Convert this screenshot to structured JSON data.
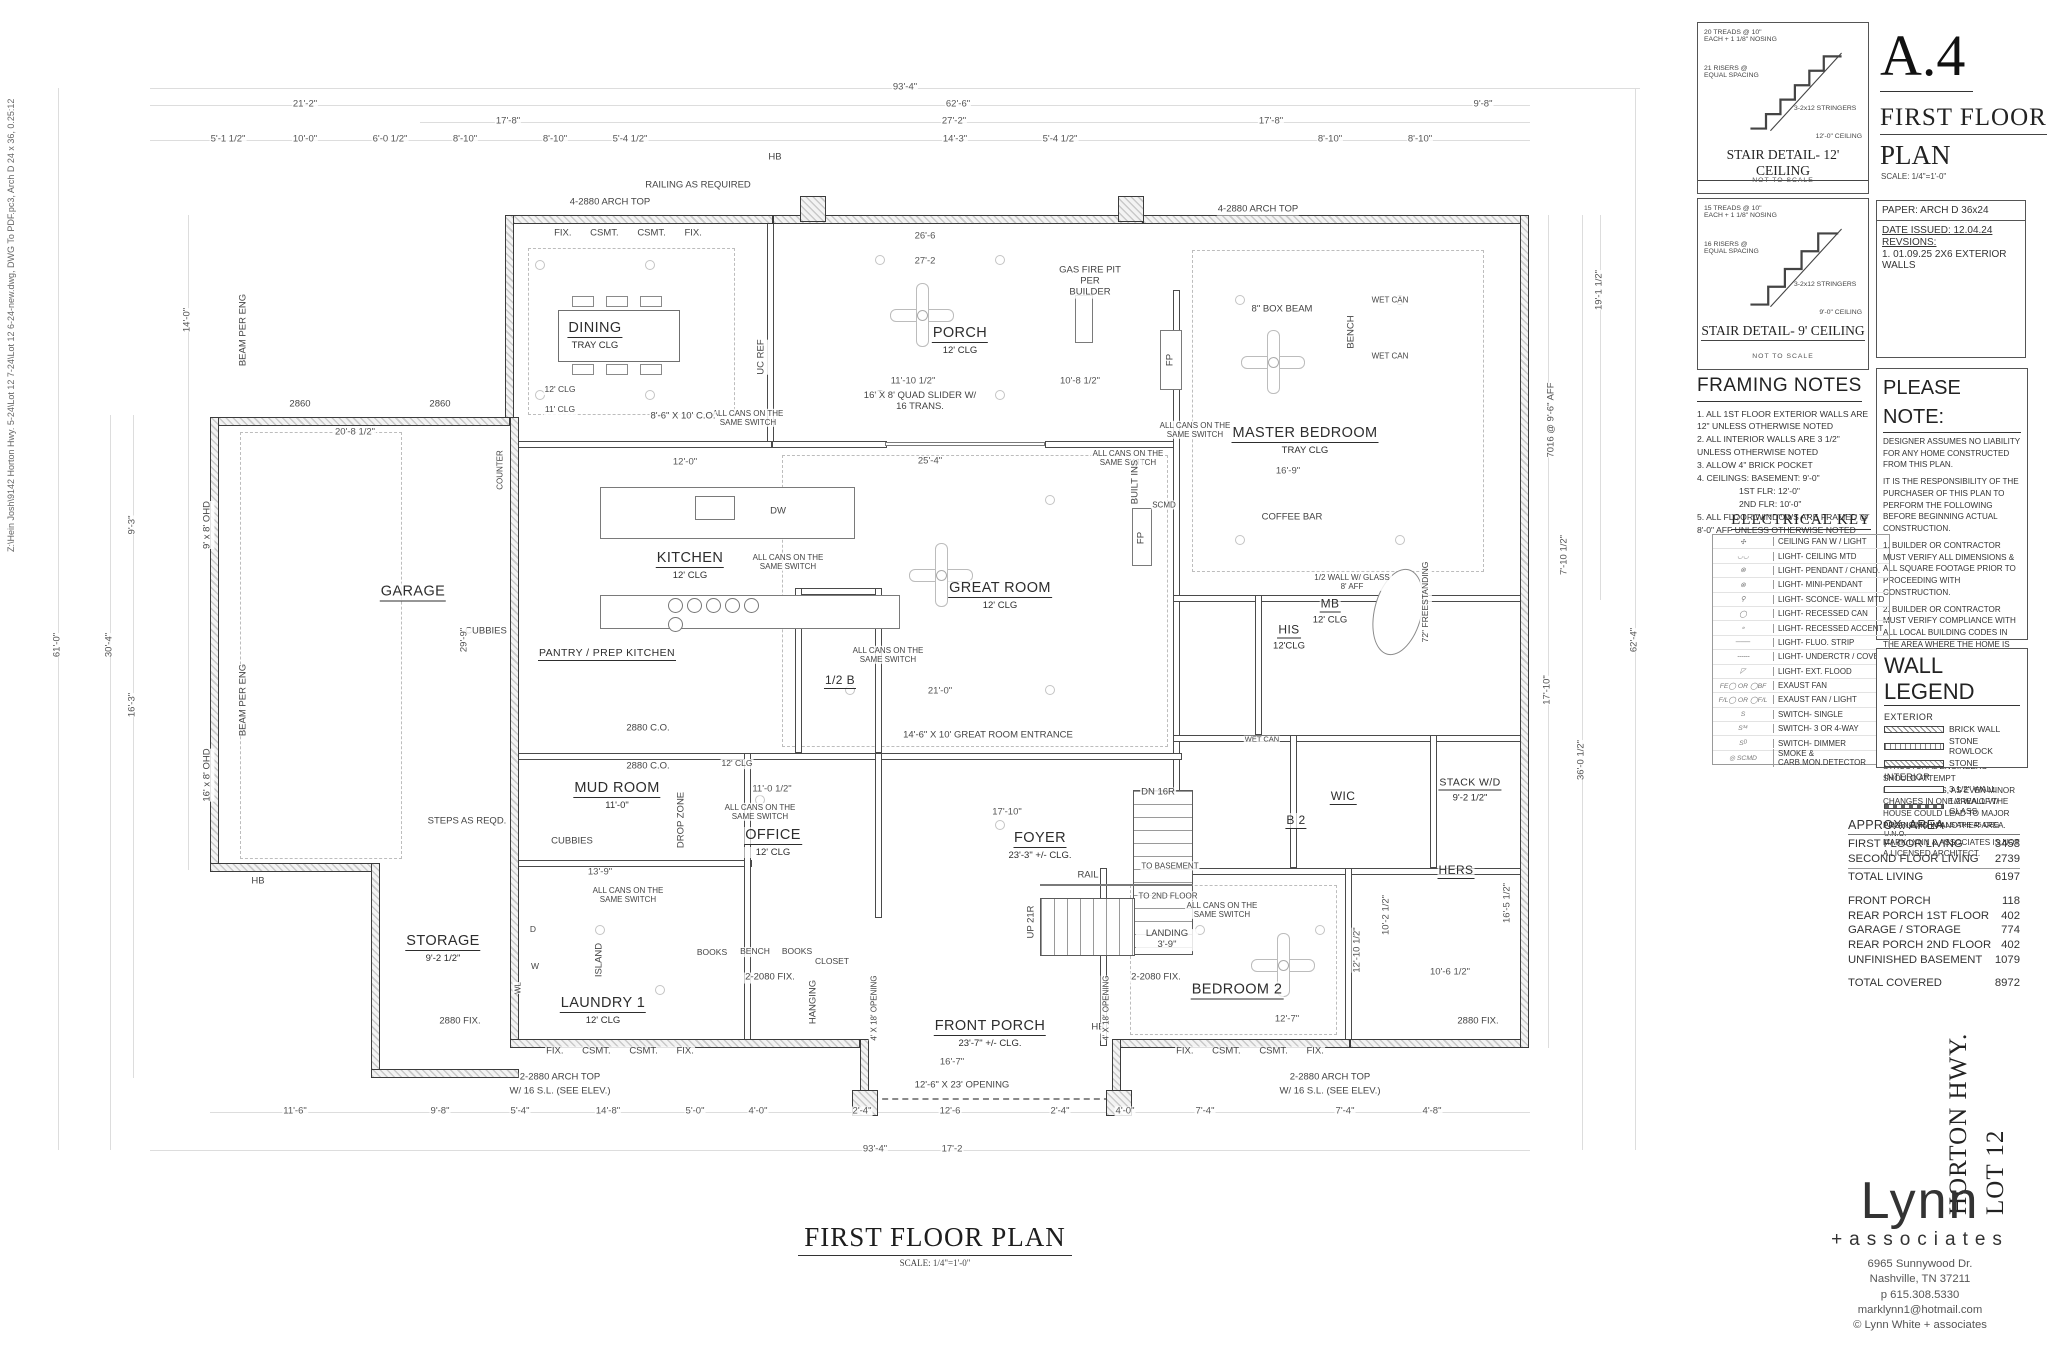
{
  "sheet": {
    "file_path_note": "Z:\\Hein Josh\\9142 Horton Hwy. 5-24\\Lot 12 7-24\\Lot 12 6-24-new.dwg, DWG To PDF.pc3, Arch D 24 x 36, 0.25:12",
    "number": "A.4",
    "title_line1": "FIRST FLOOR",
    "title_line2": "PLAN",
    "title_scale": "SCALE: 1/4\"=1'-0\"",
    "paper": "PAPER: ARCH D 36x24",
    "date_issued": "DATE ISSUED: 12.04.24",
    "revisions_label": "REVSIONS:",
    "revision_1": "1. 01.09.25 2X6 EXTERIOR WALLS"
  },
  "stair_details": [
    {
      "treads": "20 TREADS @ 10\" EACH + 1 1/8\" NOSING",
      "risers": "21 RISERS @ EQUAL SPACING",
      "stringers": "3-2x12 STRINGERS",
      "ceiling": "12'-0\" CEILING",
      "title": "STAIR DETAIL- 12' CEILING",
      "nts": "NOT TO SCALE"
    },
    {
      "treads": "15 TREADS @ 10\" EACH + 1 1/8\" NOSING",
      "risers": "16 RISERS @ EQUAL SPACING",
      "stringers": "3-2x12 STRINGERS",
      "ceiling": "9'-0\" CEILING",
      "title": "STAIR DETAIL- 9' CEILING",
      "nts": "NOT TO SCALE"
    }
  ],
  "framing_notes": {
    "title": "FRAMING NOTES",
    "lines": [
      "1. ALL 1ST FLOOR EXTERIOR WALLS ARE 12\" UNLESS OTHERWISE NOTED",
      "2. ALL INTERIOR WALLS ARE 3 1/2\" UNLESS OTHERWISE NOTED",
      "3. ALLOW 4\" BRICK POCKET",
      "4. CEILINGS: BASEMENT: 9'-0\"",
      "1ST FLR: 12'-0\"",
      "2ND FLR: 10'-0\"",
      "5. ALL FLOOR WINDOWS ARE FRAMED @ 8'-0\" AFF UNLESS OTHERWISE NOTED"
    ]
  },
  "please_note": {
    "title": "PLEASE NOTE:",
    "paragraphs": [
      "DESIGNER ASSUMES NO LIABILITY FOR ANY HOME CONSTRUCTED FROM THIS PLAN.",
      "IT IS THE RESPONSIBILITY OF THE PURCHASER OF THIS PLAN TO PERFORM THE FOLLOWING BEFORE BEGINNING ACTUAL CONSTRUCTION.",
      "1. BUILDER OR CONTRACTOR MUST VERIFY ALL DIMENSIONS & ALL SQUARE FOOTAGE PRIOR TO PROCEEDING WITH CONSTRUCTION.",
      "2. BUILDER OR CONTRACTOR MUST VERIFY COMPLIANCE WITH ALL LOCAL BUILDING CODES IN THE AREA WHERE THE HOME IS TO BE CONSTRUCTED.",
      "3. DESIGNER ASSUMES NO RESPONSIBILITY FOR STRUCTURAL ENGINEERING ASPECTS. CAUTION MUST BE EXERCISED IN MAKING ANY CHANGES IN THIS PLAN. ONLY QUALIFIED DESIGNERS, ARCHITECTS, CONTRACTORS, OR STRUCTURAL ENGINEERS SHOULD ATTEMPT MODIFICATIONS, AS EVEN MINOR CHANGES IN ONE AREA OF THE HOUSE COULD LEAD TO MAJOR PROBLEMS IN ANOTHER AREA.",
      "MARK LYNN & ASSOCIATES IS NOT A LICENSED ARCHITECT."
    ]
  },
  "electrical_key": {
    "title": "ELECTRICAL KEY",
    "rows": [
      {
        "sym": "✣",
        "label": "CEILING FAN W / LIGHT"
      },
      {
        "sym": "◡◡",
        "label": "LIGHT- CEILING MTD"
      },
      {
        "sym": "⊗",
        "label": "LIGHT- PENDANT / CHAND."
      },
      {
        "sym": "⊗",
        "label": "LIGHT- MINI-PENDANT"
      },
      {
        "sym": "⚲",
        "label": "LIGHT- SCONCE- WALL MTD"
      },
      {
        "sym": "◯",
        "label": "LIGHT- RECESSED CAN"
      },
      {
        "sym": "∘",
        "label": "LIGHT- RECESSED ACCENT"
      },
      {
        "sym": "───",
        "label": "LIGHT- FLUO. STRIP"
      },
      {
        "sym": "╌╌╌",
        "label": "LIGHT- UNDERCTR / COVE"
      },
      {
        "sym": "◸",
        "label": "LIGHT- EXT. FLOOD"
      },
      {
        "sym": "FE◯ OR ◯BF",
        "label": "EXAUST FAN"
      },
      {
        "sym": "F/L◯ OR ◯F/L",
        "label": "EXAUST FAN / LIGHT"
      },
      {
        "sym": "S",
        "label": "SWITCH- SINGLE"
      },
      {
        "sym": "S³⁴",
        "label": "SWITCH- 3 OR 4-WAY"
      },
      {
        "sym": "Sᴰ",
        "label": "SWITCH- DIMMER"
      },
      {
        "sym": "◎ SCMD",
        "label": "SMOKE & CARB.MON.DETECTOR"
      }
    ]
  },
  "wall_legend": {
    "title": "WALL LEGEND",
    "exterior_label": "EXTERIOR",
    "interior_label": "INTERIOR",
    "exterior": [
      "BRICK WALL",
      "STONE ROWLOCK",
      "STONE"
    ],
    "interior": [
      "3 1/2\" WALL",
      "1/2 WALL W/ GLASS"
    ],
    "footnote": "ALL ANGLED WALLS ARE 45 DEG U.N.O."
  },
  "area_table": {
    "title": "APPROX. AREA",
    "rows": [
      {
        "label": "FIRST FLOOR LIVING",
        "value": "3458"
      },
      {
        "label": "SECOND FLOOR LIVING",
        "value": "2739"
      },
      {
        "label": "TOTAL LIVING",
        "value": "6197"
      },
      {
        "label": "FRONT PORCH",
        "value": "118"
      },
      {
        "label": "REAR PORCH 1ST FLOOR",
        "value": "402"
      },
      {
        "label": "GARAGE / STORAGE",
        "value": "774"
      },
      {
        "label": "REAR PORCH 2ND FLOOR",
        "value": "402"
      },
      {
        "label": "UNFINISHED BASEMENT",
        "value": "1079"
      },
      {
        "label": "TOTAL COVERED",
        "value": "8972"
      }
    ]
  },
  "project": {
    "street": "HORTON HWY.",
    "lot": "LOT 12"
  },
  "brand": {
    "name": "Lynn",
    "sub": "+associates",
    "address1": "6965 Sunnywood Dr.",
    "address2": "Nashville, TN 37211",
    "phone": "p 615.308.5330",
    "email": "marklynn1@hotmail.com",
    "copyright": "© Lynn White + associates"
  },
  "plan": {
    "title": "FIRST FLOOR PLAN",
    "scale": "SCALE: 1/4\"=1'-0\"",
    "rooms": [
      {
        "name": "DINING",
        "sub": "TRAY CLG"
      },
      {
        "name": "PORCH",
        "sub": "12' CLG"
      },
      {
        "name": "MASTER BEDROOM",
        "sub": "TRAY CLG"
      },
      {
        "name": "GARAGE",
        "sub": ""
      },
      {
        "name": "KITCHEN",
        "sub": "12' CLG"
      },
      {
        "name": "PANTRY / PREP KITCHEN",
        "sub": ""
      },
      {
        "name": "GREAT ROOM",
        "sub": "12' CLG"
      },
      {
        "name": "MB",
        "sub": "12' CLG"
      },
      {
        "name": "HIS",
        "sub": "12'CLG"
      },
      {
        "name": "MUD ROOM",
        "sub": "11'-0\""
      },
      {
        "name": "OFFICE",
        "sub": "12' CLG"
      },
      {
        "name": "FOYER",
        "sub": "23'-3\" +/- CLG."
      },
      {
        "name": "STORAGE",
        "sub": "9'-2 1/2\""
      },
      {
        "name": "LAUNDRY 1",
        "sub": "12' CLG"
      },
      {
        "name": "FRONT PORCH",
        "sub": "23'-7\" +/- CLG."
      },
      {
        "name": "BEDROOM 2",
        "sub": ""
      },
      {
        "name": "B 2",
        "sub": ""
      },
      {
        "name": "WIC",
        "sub": ""
      },
      {
        "name": "HERS",
        "sub": ""
      },
      {
        "name": "STACK W/D",
        "sub": "9'-2 1/2\""
      },
      {
        "name": "1/2 B",
        "sub": ""
      }
    ],
    "notes": [
      "RAILING AS REQUIRED",
      "4-2880 ARCH TOP",
      "4-2880 ARCH TOP",
      "FIX. CSMT. CSMT. FIX.",
      "FIX. CSMT. CSMT. FIX.",
      "FIX. CSMT. CSMT. FIX.",
      "HB",
      "HB",
      "HB",
      "2860",
      "2860",
      "BEAM PER ENG",
      "9' x 8' OHD",
      "16' x 8' OHD",
      "BEAM PER ENG",
      "GAS FIRE PIT PER BUILDER",
      "8\" BOX BEAM",
      "ALL CANS ON THE SAME SWITCH",
      "ALL CANS ON THE SAME SWITCH",
      "ALL CANS ON THE SAME SWITCH",
      "ALL CANS ON THE SAME SWITCH",
      "ALL CANS ON THE SAME SWITCH",
      "ALL CANS ON THE SAME SWITCH",
      "ALL CANS ON THE SAME SWITCH",
      "ALL CANS ON THE SAME SWITCH",
      "16' X 8' QUAD SLIDER W/ 16 TRANS.",
      "8'-6\" X 10' C.O.",
      "2880 C.O.",
      "2880 C.O.",
      "UC REF",
      "DW",
      "FP",
      "FP",
      "BUILT INS",
      "WET CAN",
      "WET CAN",
      "BENCH",
      "72\" FREESTANDING",
      "1/2 WALL W/ GLASS 8' AFF",
      "CUBBIES",
      "CUBBIES",
      "DROP ZONE",
      "ISLAND",
      "BOOKS",
      "BENCH",
      "BOOKS",
      "CLOSET",
      "HANGING",
      "STEPS AS REQD.",
      "DN 16R",
      "UP 21R",
      "TO BASEMENT",
      "TO 2ND FLOOR",
      "LANDING 3'-9\"",
      "RAIL",
      "2-2080 FIX.",
      "2-2080 FIX.",
      "14'-6\" X 10' GREAT ROOM ENTRANCE",
      "2-2880 ARCH TOP",
      "W/ 16 S.L. (SEE ELEV.)",
      "2-2880 ARCH TOP",
      "W/ 16 S.L. (SEE ELEV.)",
      "12'-6\" X 23' OPENING",
      "4' X 18' OPENING",
      "4' X 18' OPENING",
      "2880 FIX.",
      "2880 FIX.",
      "SCMD",
      "12' CLG",
      "11' CLG",
      "12' CLG",
      "COUNTER",
      "D",
      "W",
      "WL",
      "WET CAN",
      "COFFEE BAR"
    ],
    "dims": [
      "93'-4\"",
      "21'-2\"",
      "62'-6\"",
      "9'-8\"",
      "17'-8\"",
      "27'-2\"",
      "17'-8\"",
      "5'-1 1/2\"",
      "10'-0\"",
      "6'-0 1/2\"",
      "8'-10\"",
      "8'-10\"",
      "5'-4 1/2\"",
      "14'-3\"",
      "5'-4 1/2\"",
      "8'-10\"",
      "8'-10\"",
      "61'-0\"",
      "30'-4\"",
      "14'-0\"",
      "9'-3\"",
      "16'-3\"",
      "62'-4\"",
      "36'-0 1/2\"",
      "17'-10\"",
      "19'-1 1/2\"",
      "7'-10 1/2\"",
      "11'-6\"",
      "9'-8\"",
      "5'-4\"",
      "14'-8\"",
      "5'-0\"",
      "4'-0\"",
      "12'-6",
      "2'-4\"",
      "2'-4\"",
      "7'-4\"",
      "7'-4\"",
      "4'-8\"",
      "93'-4\"",
      "17'-2",
      "25'-4\"",
      "21'-0\"",
      "12'-0\"",
      "16'-9\"",
      "12'-7\"",
      "11'-0 1/2\"",
      "13'-9\"",
      "17'-10\"",
      "11'-10 1/2\"",
      "10'-8 1/2\"",
      "26'-6",
      "27'-2",
      "20'-8 1/2\"",
      "29'-9\"",
      "7016 @ 9'-6\" AFF",
      "16'-7\"",
      "16'-5 1/2\"",
      "10'-6 1/2\"",
      "12'-10 1/2\"",
      "10'-2 1/2\"",
      "4'-0\""
    ]
  }
}
